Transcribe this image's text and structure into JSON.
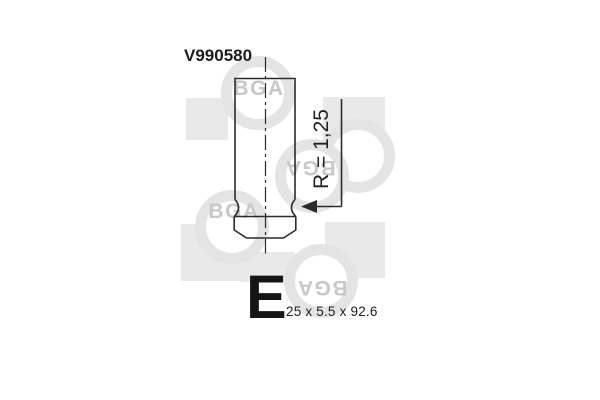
{
  "header": {
    "part_number": "V990580"
  },
  "diagram": {
    "radius_label": "R = 1,25",
    "valve_type_letter": "E",
    "dimensions_label": "25 x 5.5 x 92.6",
    "line_color": "#2b2b2b"
  },
  "watermark": {
    "brand": "BGA",
    "square_color": "#e9e9e9",
    "ring_color": "#e4e4e4",
    "letter_color": "#c8c8c8"
  }
}
